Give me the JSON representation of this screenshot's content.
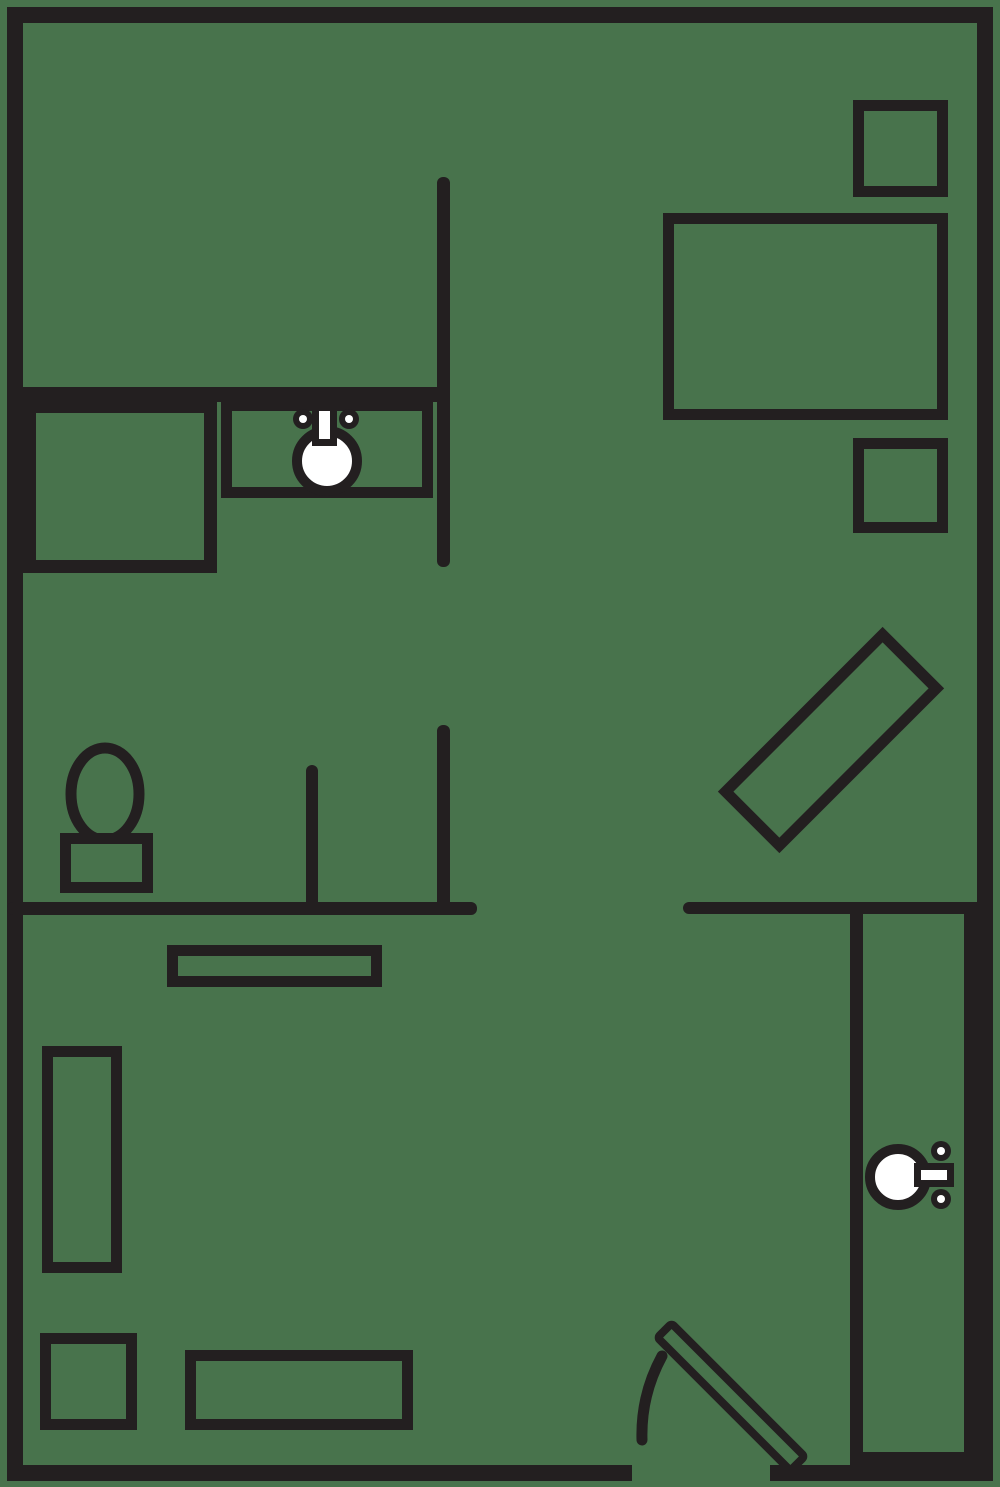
{
  "colors": {
    "background": "#48734C",
    "line": "#231F20",
    "white": "#FFFFFF"
  },
  "canvas": {
    "width": 1000,
    "height": 1487
  },
  "floorplan": {
    "elements": [
      {
        "name": "entry-door-leaf",
        "tag": "rect",
        "attrs": {
          "x": 637,
          "y": 1387,
          "width": 188,
          "height": 20,
          "rx": 3,
          "fill": "@background",
          "stroke": "@line",
          "stroke-width": 8,
          "transform": "rotate(45 731 1397)"
        }
      },
      {
        "name": "entry-door-swing-arc",
        "tag": "path",
        "attrs": {
          "d": "M 662 1356 A 165 165 0 0 0 642 1440",
          "fill": "none",
          "stroke": "@line",
          "stroke-width": 11,
          "stroke-linecap": "round"
        }
      },
      {
        "name": "wall-north",
        "tag": "rect",
        "attrs": {
          "x": 7,
          "y": 7,
          "width": 986,
          "height": 16,
          "fill": "@line"
        }
      },
      {
        "name": "wall-west",
        "tag": "rect",
        "attrs": {
          "x": 7,
          "y": 7,
          "width": 16,
          "height": 1474,
          "fill": "@line"
        }
      },
      {
        "name": "wall-east",
        "tag": "rect",
        "attrs": {
          "x": 977,
          "y": 7,
          "width": 16,
          "height": 1474,
          "fill": "@line"
        }
      },
      {
        "name": "wall-south-left",
        "tag": "rect",
        "attrs": {
          "x": 7,
          "y": 1465,
          "width": 625,
          "height": 16,
          "fill": "@line"
        }
      },
      {
        "name": "wall-south-right",
        "tag": "rect",
        "attrs": {
          "x": 770,
          "y": 1465,
          "width": 223,
          "height": 16,
          "fill": "@line"
        }
      },
      {
        "name": "wall-kitchen-south",
        "tag": "rect",
        "attrs": {
          "x": 7,
          "y": 387,
          "width": 443,
          "height": 15,
          "fill": "@line"
        }
      },
      {
        "name": "wall-divider-upper",
        "tag": "rect",
        "attrs": {
          "x": 437,
          "y": 177,
          "width": 13,
          "height": 390,
          "rx": 6,
          "fill": "@line"
        }
      },
      {
        "name": "wall-divider-lower",
        "tag": "rect",
        "attrs": {
          "x": 437,
          "y": 725,
          "width": 13,
          "height": 188,
          "rx": 6,
          "fill": "@line"
        }
      },
      {
        "name": "wall-bathroom-stub",
        "tag": "rect",
        "attrs": {
          "x": 306,
          "y": 765,
          "width": 12,
          "height": 148,
          "rx": 6,
          "fill": "@line"
        }
      },
      {
        "name": "wall-hall-west",
        "tag": "rect",
        "attrs": {
          "x": 7,
          "y": 902,
          "width": 470,
          "height": 13,
          "rx": 6,
          "fill": "@line"
        }
      },
      {
        "name": "wall-hall-east",
        "tag": "rect",
        "attrs": {
          "x": 683,
          "y": 902,
          "width": 294,
          "height": 12,
          "rx": 6,
          "fill": "@line"
        }
      },
      {
        "name": "wall-ensuite-west",
        "tag": "rect",
        "attrs": {
          "x": 850,
          "y": 902,
          "width": 13,
          "height": 563,
          "fill": "@line"
        }
      },
      {
        "name": "wall-ensuite-east",
        "tag": "rect",
        "attrs": {
          "x": 964,
          "y": 902,
          "width": 13,
          "height": 579,
          "fill": "@line"
        }
      },
      {
        "name": "wall-ensuite-south",
        "tag": "rect",
        "attrs": {
          "x": 850,
          "y": 1452,
          "width": 143,
          "height": 14,
          "fill": "@line"
        }
      },
      {
        "name": "bed",
        "tag": "rect",
        "attrs": {
          "x": 668.5,
          "y": 218.5,
          "width": 274,
          "height": 196,
          "fill": "none",
          "stroke": "@line",
          "stroke-width": 11
        }
      },
      {
        "name": "nightstand-north",
        "tag": "rect",
        "attrs": {
          "x": 858.5,
          "y": 105.5,
          "width": 84,
          "height": 86,
          "fill": "none",
          "stroke": "@line",
          "stroke-width": 11
        }
      },
      {
        "name": "nightstand-south",
        "tag": "rect",
        "attrs": {
          "x": 858.5,
          "y": 443.5,
          "width": 84,
          "height": 84,
          "fill": "none",
          "stroke": "@line",
          "stroke-width": 11
        }
      },
      {
        "name": "dresser-diagonal",
        "tag": "rect",
        "attrs": {
          "x": 720,
          "y": 702,
          "width": 222,
          "height": 76,
          "fill": "none",
          "stroke": "@line",
          "stroke-width": 11,
          "transform": "rotate(-45 831 740)"
        }
      },
      {
        "name": "kitchen-closet-box",
        "tag": "rect",
        "attrs": {
          "x": 29.5,
          "y": 406.5,
          "width": 181,
          "height": 160,
          "fill": "none",
          "stroke": "@line",
          "stroke-width": 13
        }
      },
      {
        "name": "vanity-counter",
        "tag": "rect",
        "attrs": {
          "x": 226.5,
          "y": 405.5,
          "width": 201,
          "height": 87,
          "fill": "none",
          "stroke": "@line",
          "stroke-width": 11
        }
      },
      {
        "name": "shelf-counter",
        "tag": "rect",
        "attrs": {
          "x": 172.5,
          "y": 950.5,
          "width": 204,
          "height": 31,
          "fill": "none",
          "stroke": "@line",
          "stroke-width": 11
        }
      },
      {
        "name": "sofa",
        "tag": "rect",
        "attrs": {
          "x": 47.5,
          "y": 1051.5,
          "width": 69,
          "height": 216,
          "fill": "none",
          "stroke": "@line",
          "stroke-width": 11
        }
      },
      {
        "name": "side-table",
        "tag": "rect",
        "attrs": {
          "x": 45.5,
          "y": 1338.5,
          "width": 86,
          "height": 86,
          "fill": "none",
          "stroke": "@line",
          "stroke-width": 11
        }
      },
      {
        "name": "coffee-table",
        "tag": "rect",
        "attrs": {
          "x": 190.5,
          "y": 1355.5,
          "width": 217,
          "height": 69,
          "fill": "none",
          "stroke": "@line",
          "stroke-width": 11
        }
      },
      {
        "name": "toilet-bowl",
        "tag": "ellipse",
        "attrs": {
          "cx": 105,
          "cy": 794,
          "rx": 34,
          "ry": 46,
          "fill": "@background",
          "stroke": "@line",
          "stroke-width": 11
        }
      },
      {
        "name": "toilet-tank",
        "tag": "rect",
        "attrs": {
          "x": 65.5,
          "y": 838.5,
          "width": 82,
          "height": 49,
          "fill": "@background",
          "stroke": "@line",
          "stroke-width": 11
        }
      },
      {
        "name": "vanity-sink-basin",
        "tag": "circle",
        "attrs": {
          "cx": 327,
          "cy": 461,
          "r": 30,
          "fill": "@white",
          "stroke": "@line",
          "stroke-width": 10
        }
      },
      {
        "name": "vanity-faucet",
        "tag": "rect",
        "attrs": {
          "x": 315.5,
          "y": 407.5,
          "width": 18,
          "height": 35,
          "fill": "@white",
          "stroke": "@line",
          "stroke-width": 7
        }
      },
      {
        "name": "vanity-knob-left",
        "tag": "circle",
        "attrs": {
          "cx": 303,
          "cy": 419,
          "r": 10,
          "fill": "@line"
        }
      },
      {
        "name": "vanity-knob-left-dot",
        "tag": "circle",
        "attrs": {
          "cx": 303,
          "cy": 419,
          "r": 4,
          "fill": "@white"
        }
      },
      {
        "name": "vanity-knob-right",
        "tag": "circle",
        "attrs": {
          "cx": 349,
          "cy": 419,
          "r": 10,
          "fill": "@line"
        }
      },
      {
        "name": "vanity-knob-right-dot",
        "tag": "circle",
        "attrs": {
          "cx": 349,
          "cy": 419,
          "r": 4,
          "fill": "@white"
        }
      },
      {
        "name": "ensuite-sink-basin",
        "tag": "circle",
        "attrs": {
          "cx": 898,
          "cy": 1177,
          "r": 28,
          "fill": "@white",
          "stroke": "@line",
          "stroke-width": 10
        }
      },
      {
        "name": "ensuite-faucet",
        "tag": "rect",
        "attrs": {
          "x": 917.5,
          "y": 1166.5,
          "width": 33,
          "height": 17,
          "fill": "@white",
          "stroke": "@line",
          "stroke-width": 7
        }
      },
      {
        "name": "ensuite-knob-top",
        "tag": "circle",
        "attrs": {
          "cx": 941,
          "cy": 1151,
          "r": 10,
          "fill": "@line"
        }
      },
      {
        "name": "ensuite-knob-top-dot",
        "tag": "circle",
        "attrs": {
          "cx": 941,
          "cy": 1151,
          "r": 4,
          "fill": "@white"
        }
      },
      {
        "name": "ensuite-knob-bottom",
        "tag": "circle",
        "attrs": {
          "cx": 941,
          "cy": 1199,
          "r": 10,
          "fill": "@line"
        }
      },
      {
        "name": "ensuite-knob-bottom-dot",
        "tag": "circle",
        "attrs": {
          "cx": 941,
          "cy": 1199,
          "r": 4,
          "fill": "@white"
        }
      }
    ]
  }
}
